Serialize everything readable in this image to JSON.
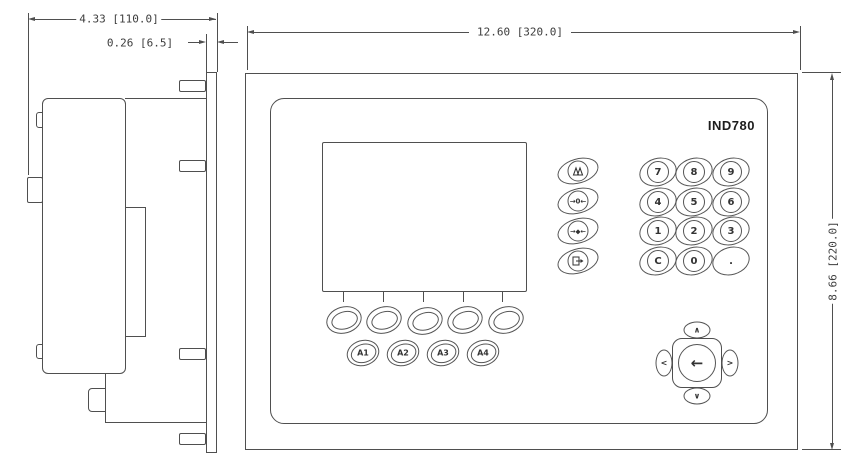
{
  "dimensions": {
    "depth_behind_panel": "4.33 [110.0]",
    "panel_thickness": "0.26 [6.5]",
    "front_width": "12.60 [320.0]",
    "front_height": "8.66 [220.0]"
  },
  "front_panel": {
    "model_label": "IND780",
    "softkey_count": 5,
    "application_keys": [
      "A1",
      "A2",
      "A3",
      "A4"
    ],
    "function_keys": [
      {
        "name": "scale-select",
        "glyph": ""
      },
      {
        "name": "zero",
        "glyph": "→0←"
      },
      {
        "name": "tare",
        "glyph": "→◆←"
      },
      {
        "name": "print",
        "glyph": ""
      }
    ],
    "numeric_keypad": {
      "rows": [
        [
          "7",
          "8",
          "9"
        ],
        [
          "4",
          "5",
          "6"
        ],
        [
          "1",
          "2",
          "3"
        ],
        [
          "C",
          "0",
          "."
        ]
      ]
    },
    "navigation": {
      "up": "∧",
      "down": "∨",
      "left": "<",
      "right": ">",
      "enter": "←"
    }
  }
}
